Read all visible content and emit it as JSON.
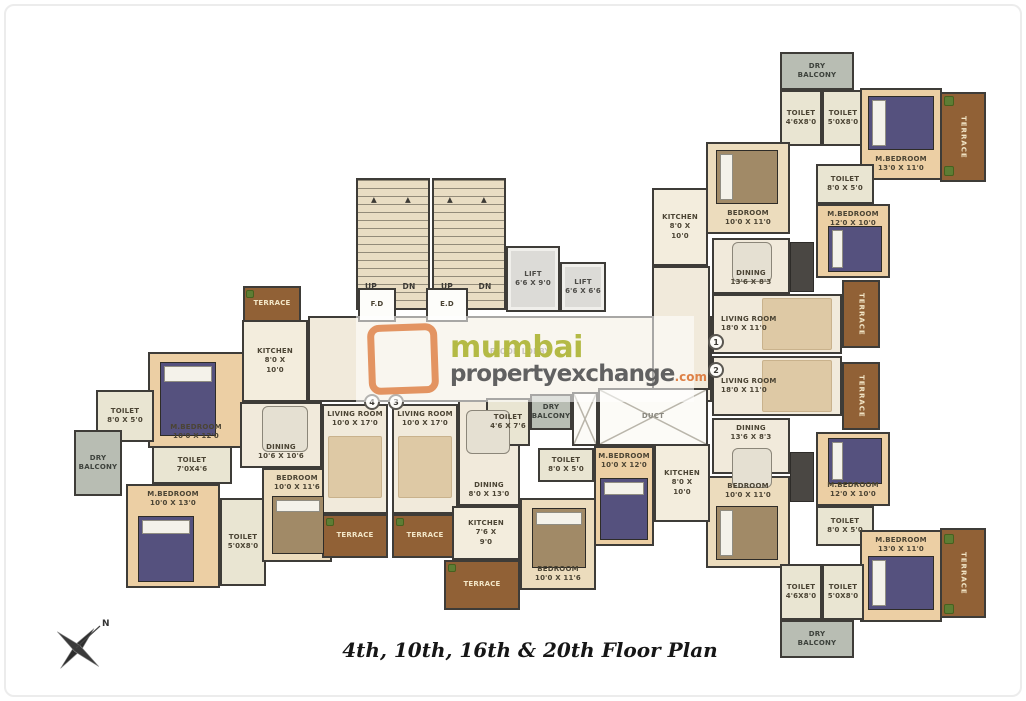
{
  "meta": {
    "title": "4th, 10th, 16th & 20th Floor Plan",
    "compass_label": "N"
  },
  "watermark": {
    "brand_top": "mumbai",
    "brand_bottom": "propertyexchange",
    "brand_suffix": ".com",
    "lobby_label": "FLOOR LOBBY"
  },
  "palette": {
    "wall": "#3e3c38",
    "floor_cream": "#f1eadb",
    "bedroom_tan": "#eccfa4",
    "bedroom_light": "#ecdcbd",
    "toilet": "#e9e5d2",
    "terrace_wood": "#916136",
    "dry_balcony_gray": "#b8bdb3",
    "bed_purple": "#55517e",
    "bed_brown": "#a18a67",
    "plant_green": "#5e7d34",
    "logo_orange": "#e08952",
    "brand_olive": "#b4ba45",
    "brand_gray": "#616161"
  },
  "rooms": [
    {
      "name": "lobby",
      "type": "floor",
      "x": 308,
      "y": 316,
      "w": 404,
      "h": 86
    },
    {
      "name": "corridor-right",
      "type": "floor",
      "x": 652,
      "y": 266,
      "w": 58,
      "h": 124
    },
    {
      "name": "dining-center",
      "type": "floor",
      "x": 458,
      "y": 400,
      "w": 62,
      "h": 106,
      "label": [
        "DINING",
        "8'0 X 13'0"
      ],
      "at": "bottom"
    },
    {
      "name": "stairs-left",
      "type": "stairs",
      "x": 356,
      "y": 178,
      "w": 74,
      "h": 132
    },
    {
      "name": "stairs-right",
      "type": "stairs",
      "x": 432,
      "y": 178,
      "w": 74,
      "h": 132
    },
    {
      "name": "lift-1",
      "type": "lift",
      "x": 506,
      "y": 246,
      "w": 54,
      "h": 66,
      "label": [
        "LIFT",
        "6'6 X 9'0"
      ]
    },
    {
      "name": "lift-2",
      "type": "lift",
      "x": 560,
      "y": 262,
      "w": 46,
      "h": 50,
      "label": [
        "LIFT",
        "6'6 X 6'6"
      ]
    },
    {
      "name": "fd-room",
      "type": "white",
      "x": 358,
      "y": 288,
      "w": 38,
      "h": 34,
      "label": [
        "F.D"
      ]
    },
    {
      "name": "ed-room",
      "type": "white",
      "x": 426,
      "y": 288,
      "w": 42,
      "h": 34,
      "label": [
        "E.D"
      ]
    },
    {
      "name": "terrace-top-left",
      "type": "terrace",
      "x": 243,
      "y": 286,
      "w": 58,
      "h": 36,
      "label": [
        "TERRACE"
      ]
    },
    {
      "name": "kitchen-left",
      "type": "kitchen",
      "x": 242,
      "y": 320,
      "w": 66,
      "h": 82,
      "label": [
        "KITCHEN",
        "8'0 X",
        "10'0"
      ]
    },
    {
      "name": "mbedroom-left-1",
      "type": "tan",
      "x": 148,
      "y": 352,
      "w": 96,
      "h": 96,
      "label": [
        "M.BEDROOM",
        "10'0 X 12'0"
      ],
      "at": "bottom"
    },
    {
      "name": "toilet-left-1",
      "type": "toilet",
      "x": 96,
      "y": 390,
      "w": 58,
      "h": 52,
      "label": [
        "TOILET",
        "8'0 X 5'0"
      ]
    },
    {
      "name": "drybalcony-left",
      "type": "balcony",
      "x": 74,
      "y": 430,
      "w": 48,
      "h": 66,
      "label": [
        "DRY",
        "BALCONY"
      ]
    },
    {
      "name": "toilet-left-2",
      "type": "toilet",
      "x": 152,
      "y": 446,
      "w": 80,
      "h": 38,
      "label": [
        "TOILET",
        "7'0X4'6"
      ]
    },
    {
      "name": "mbedroom-left-2",
      "type": "tan",
      "x": 126,
      "y": 484,
      "w": 94,
      "h": 104,
      "label": [
        "M.BEDROOM",
        "10'0 X 13'0"
      ],
      "at": "top"
    },
    {
      "name": "toilet-left-3",
      "type": "toilet",
      "x": 220,
      "y": 498,
      "w": 46,
      "h": 88,
      "label": [
        "TOILET",
        "5'0X8'0"
      ]
    },
    {
      "name": "bedroom-left",
      "type": "tanlight",
      "x": 262,
      "y": 468,
      "w": 70,
      "h": 94,
      "label": [
        "BEDROOM",
        "10'0 X 11'6"
      ],
      "at": "top"
    },
    {
      "name": "dining-left",
      "type": "floor",
      "x": 240,
      "y": 402,
      "w": 82,
      "h": 66,
      "label": [
        "DINING",
        "10'6 X 10'6"
      ],
      "at": "bottom"
    },
    {
      "name": "living-room-4",
      "type": "floor",
      "x": 322,
      "y": 404,
      "w": 66,
      "h": 110,
      "label": [
        "LIVING ROOM",
        "10'0 X 17'0"
      ],
      "at": "top"
    },
    {
      "name": "terrace-4",
      "type": "terrace",
      "x": 322,
      "y": 514,
      "w": 66,
      "h": 44,
      "label": [
        "TERRACE"
      ]
    },
    {
      "name": "living-room-3",
      "type": "floor",
      "x": 392,
      "y": 404,
      "w": 66,
      "h": 110,
      "label": [
        "LIVING ROOM",
        "10'0 X 17'0"
      ],
      "at": "top"
    },
    {
      "name": "terrace-3",
      "type": "terrace",
      "x": 392,
      "y": 514,
      "w": 66,
      "h": 44,
      "label": [
        "TERRACE"
      ]
    },
    {
      "name": "toilet-center-1",
      "type": "toilet",
      "x": 486,
      "y": 398,
      "w": 44,
      "h": 48,
      "label": [
        "TOILET",
        "4'6 X 7'6"
      ]
    },
    {
      "name": "drybalcony-center",
      "type": "balcony",
      "x": 530,
      "y": 394,
      "w": 42,
      "h": 36,
      "label": [
        "DRY",
        "BALCONY"
      ]
    },
    {
      "name": "duct-shaft",
      "type": "duct",
      "x": 572,
      "y": 392,
      "w": 26,
      "h": 54
    },
    {
      "name": "duct",
      "type": "duct",
      "x": 598,
      "y": 388,
      "w": 110,
      "h": 58,
      "label": [
        "DUCT"
      ]
    },
    {
      "name": "toilet-center-2",
      "type": "toilet",
      "x": 538,
      "y": 448,
      "w": 56,
      "h": 34,
      "label": [
        "TOILET",
        "8'0 X 5'0"
      ]
    },
    {
      "name": "mbedroom-center",
      "type": "tan",
      "x": 594,
      "y": 446,
      "w": 60,
      "h": 100,
      "label": [
        "M.BEDROOM",
        "10'0 X 12'0"
      ],
      "at": "top"
    },
    {
      "name": "kitchen-center",
      "type": "kitchen",
      "x": 452,
      "y": 506,
      "w": 68,
      "h": 54,
      "label": [
        "KITCHEN",
        "7'6 X",
        "9'0"
      ]
    },
    {
      "name": "terrace-center",
      "type": "terrace",
      "x": 444,
      "y": 560,
      "w": 76,
      "h": 50,
      "label": [
        "TERRACE"
      ]
    },
    {
      "name": "bedroom-center",
      "type": "tanlight",
      "x": 520,
      "y": 498,
      "w": 76,
      "h": 92,
      "label": [
        "BEDROOM",
        "10'0 X 11'6"
      ],
      "at": "bottom"
    },
    {
      "name": "drybalcony-right-1",
      "type": "balcony",
      "x": 780,
      "y": 52,
      "w": 74,
      "h": 38,
      "label": [
        "DRY",
        "BALCONY"
      ]
    },
    {
      "name": "toilet-1a",
      "type": "toilet",
      "x": 780,
      "y": 90,
      "w": 42,
      "h": 56,
      "label": [
        "TOILET",
        "4'6X8'0"
      ]
    },
    {
      "name": "toilet-1b",
      "type": "toilet",
      "x": 822,
      "y": 90,
      "w": 42,
      "h": 56,
      "label": [
        "TOILET",
        "5'0X8'0"
      ]
    },
    {
      "name": "mbedroom-1a",
      "type": "tan",
      "x": 860,
      "y": 88,
      "w": 82,
      "h": 92,
      "label": [
        "M.BEDROOM",
        "13'0 X 11'0"
      ],
      "at": "bottom"
    },
    {
      "name": "terrace-1",
      "type": "terrace",
      "x": 940,
      "y": 92,
      "w": 46,
      "h": 90,
      "label": [
        "TERRACE"
      ],
      "vert": true
    },
    {
      "name": "bedroom-1",
      "type": "tanlight",
      "x": 706,
      "y": 142,
      "w": 84,
      "h": 92,
      "label": [
        "BEDROOM",
        "10'0 X 11'0"
      ],
      "at": "bottom"
    },
    {
      "name": "kitchen-1",
      "type": "kitchen",
      "x": 652,
      "y": 188,
      "w": 56,
      "h": 78,
      "label": [
        "KITCHEN",
        "8'0 X",
        "10'0"
      ]
    },
    {
      "name": "toilet-1c",
      "type": "toilet",
      "x": 816,
      "y": 164,
      "w": 58,
      "h": 40,
      "label": [
        "TOILET",
        "8'0 X 5'0"
      ]
    },
    {
      "name": "mbedroom-1b",
      "type": "tan",
      "x": 816,
      "y": 204,
      "w": 74,
      "h": 74,
      "label": [
        "M.BEDROOM",
        "12'0 X 10'0"
      ],
      "at": "top"
    },
    {
      "name": "terrace-1-side",
      "type": "terrace",
      "x": 842,
      "y": 280,
      "w": 38,
      "h": 68,
      "label": [
        "TERRACE"
      ],
      "vert": true
    },
    {
      "name": "dining-1",
      "type": "floor",
      "x": 712,
      "y": 238,
      "w": 78,
      "h": 56,
      "label": [
        "DINING",
        "13'6 X 8'3"
      ],
      "at": "bottom"
    },
    {
      "name": "living-room-1",
      "type": "floor",
      "x": 712,
      "y": 294,
      "w": 130,
      "h": 60,
      "label": [
        "LIVING ROOM",
        "18'0 X 11'0"
      ],
      "at": "left"
    },
    {
      "name": "living-room-2",
      "type": "floor",
      "x": 712,
      "y": 356,
      "w": 130,
      "h": 60,
      "label": [
        "LIVING ROOM",
        "18'0 X 11'0"
      ],
      "at": "left"
    },
    {
      "name": "dining-2",
      "type": "floor",
      "x": 712,
      "y": 418,
      "w": 78,
      "h": 56,
      "label": [
        "DINING",
        "13'6 X 8'3"
      ],
      "at": "top"
    },
    {
      "name": "terrace-2-side",
      "type": "terrace",
      "x": 842,
      "y": 362,
      "w": 38,
      "h": 68,
      "label": [
        "TERRACE"
      ],
      "vert": true
    },
    {
      "name": "mbedroom-2b",
      "type": "tan",
      "x": 816,
      "y": 432,
      "w": 74,
      "h": 74,
      "label": [
        "M.BEDROOM",
        "12'0 X 10'0"
      ],
      "at": "bottom"
    },
    {
      "name": "toilet-2c",
      "type": "toilet",
      "x": 816,
      "y": 506,
      "w": 58,
      "h": 40,
      "label": [
        "TOILET",
        "8'0 X 5'0"
      ]
    },
    {
      "name": "bedroom-2",
      "type": "tanlight",
      "x": 706,
      "y": 476,
      "w": 84,
      "h": 92,
      "label": [
        "BEDROOM",
        "10'0 X 11'0"
      ],
      "at": "top"
    },
    {
      "name": "kitchen-2",
      "type": "kitchen",
      "x": 654,
      "y": 444,
      "w": 56,
      "h": 78,
      "label": [
        "KITCHEN",
        "8'0 X",
        "10'0"
      ]
    },
    {
      "name": "mbedroom-2a",
      "type": "tan",
      "x": 860,
      "y": 530,
      "w": 82,
      "h": 92,
      "label": [
        "M.BEDROOM",
        "13'0 X 11'0"
      ],
      "at": "top"
    },
    {
      "name": "terrace-2",
      "type": "terrace",
      "x": 940,
      "y": 528,
      "w": 46,
      "h": 90,
      "label": [
        "TERRACE"
      ],
      "vert": true
    },
    {
      "name": "toilet-2a",
      "type": "toilet",
      "x": 780,
      "y": 564,
      "w": 42,
      "h": 56,
      "label": [
        "TOILET",
        "4'6X8'0"
      ]
    },
    {
      "name": "toilet-2b",
      "type": "toilet",
      "x": 822,
      "y": 564,
      "w": 42,
      "h": 56,
      "label": [
        "TOILET",
        "5'0X8'0"
      ]
    },
    {
      "name": "drybalcony-right-2",
      "type": "balcony",
      "x": 780,
      "y": 620,
      "w": 74,
      "h": 38,
      "label": [
        "DRY",
        "BALCONY"
      ]
    },
    {
      "name": "up-label-1",
      "type": "plain",
      "noborder": true,
      "x": 358,
      "y": 280,
      "w": 26,
      "h": 14,
      "label": [
        "UP"
      ]
    },
    {
      "name": "dn-label-1",
      "type": "plain",
      "noborder": true,
      "x": 396,
      "y": 280,
      "w": 26,
      "h": 14,
      "label": [
        "DN"
      ]
    },
    {
      "name": "up-label-2",
      "type": "plain",
      "noborder": true,
      "x": 434,
      "y": 280,
      "w": 26,
      "h": 14,
      "label": [
        "UP"
      ]
    },
    {
      "name": "dn-label-2",
      "type": "plain",
      "noborder": true,
      "x": 472,
      "y": 280,
      "w": 26,
      "h": 14,
      "label": [
        "DN"
      ]
    },
    {
      "name": "stair-arrow-1",
      "type": "plain",
      "noborder": true,
      "x": 366,
      "y": 194,
      "w": 16,
      "h": 12,
      "label": [
        "▲"
      ]
    },
    {
      "name": "stair-arrow-2",
      "type": "plain",
      "noborder": true,
      "x": 400,
      "y": 194,
      "w": 16,
      "h": 12,
      "label": [
        "▲"
      ]
    },
    {
      "name": "stair-arrow-3",
      "type": "plain",
      "noborder": true,
      "x": 442,
      "y": 194,
      "w": 16,
      "h": 12,
      "label": [
        "▲"
      ]
    },
    {
      "name": "stair-arrow-4",
      "type": "plain",
      "noborder": true,
      "x": 476,
      "y": 194,
      "w": 16,
      "h": 12,
      "label": [
        "▲"
      ]
    }
  ],
  "furniture": [
    {
      "kind": "bed-purple",
      "p": "top",
      "x": 160,
      "y": 362,
      "w": 56,
      "h": 74
    },
    {
      "kind": "bed-purple",
      "p": "top",
      "x": 138,
      "y": 516,
      "w": 56,
      "h": 66
    },
    {
      "kind": "bed-purple",
      "p": "top",
      "x": 600,
      "y": 478,
      "w": 48,
      "h": 62
    },
    {
      "kind": "bed-purple",
      "p": "left",
      "x": 868,
      "y": 96,
      "w": 66,
      "h": 54
    },
    {
      "kind": "bed-purple",
      "p": "left",
      "x": 828,
      "y": 226,
      "w": 54,
      "h": 46
    },
    {
      "kind": "bed-purple",
      "p": "left",
      "x": 828,
      "y": 438,
      "w": 54,
      "h": 46
    },
    {
      "kind": "bed-purple",
      "p": "left",
      "x": 868,
      "y": 556,
      "w": 66,
      "h": 54
    },
    {
      "kind": "bed-brown",
      "p": "top",
      "x": 272,
      "y": 496,
      "w": 52,
      "h": 58
    },
    {
      "kind": "bed-brown",
      "p": "top",
      "x": 532,
      "y": 508,
      "w": 54,
      "h": 60
    },
    {
      "kind": "bed-brown",
      "p": "left",
      "x": 716,
      "y": 150,
      "w": 62,
      "h": 54
    },
    {
      "kind": "bed-brown",
      "p": "left",
      "x": 716,
      "y": 506,
      "w": 62,
      "h": 54
    },
    {
      "kind": "table",
      "x": 262,
      "y": 406,
      "w": 46,
      "h": 46
    },
    {
      "kind": "table",
      "x": 466,
      "y": 410,
      "w": 44,
      "h": 44
    },
    {
      "kind": "table",
      "x": 732,
      "y": 242,
      "w": 40,
      "h": 40
    },
    {
      "kind": "table",
      "x": 732,
      "y": 448,
      "w": 40,
      "h": 40
    },
    {
      "kind": "rug",
      "x": 328,
      "y": 436,
      "w": 54,
      "h": 62
    },
    {
      "kind": "rug",
      "x": 398,
      "y": 436,
      "w": 54,
      "h": 62
    },
    {
      "kind": "rug",
      "x": 762,
      "y": 298,
      "w": 70,
      "h": 52
    },
    {
      "kind": "rug",
      "x": 762,
      "y": 360,
      "w": 70,
      "h": 52
    },
    {
      "kind": "wardrobe",
      "x": 790,
      "y": 242,
      "w": 24,
      "h": 50
    },
    {
      "kind": "wardrobe",
      "x": 790,
      "y": 452,
      "w": 24,
      "h": 50
    },
    {
      "kind": "plant",
      "x": 944,
      "y": 96,
      "w": 10,
      "h": 10
    },
    {
      "kind": "plant",
      "x": 944,
      "y": 166,
      "w": 10,
      "h": 10
    },
    {
      "kind": "plant",
      "x": 944,
      "y": 534,
      "w": 10,
      "h": 10
    },
    {
      "kind": "plant",
      "x": 944,
      "y": 604,
      "w": 10,
      "h": 10
    },
    {
      "kind": "plant",
      "x": 246,
      "y": 290,
      "w": 8,
      "h": 8
    },
    {
      "kind": "plant",
      "x": 448,
      "y": 564,
      "w": 8,
      "h": 8
    },
    {
      "kind": "plant",
      "x": 326,
      "y": 518,
      "w": 8,
      "h": 8
    },
    {
      "kind": "plant",
      "x": 396,
      "y": 518,
      "w": 8,
      "h": 8
    }
  ],
  "unit_markers": [
    {
      "n": "4",
      "x": 364,
      "y": 394
    },
    {
      "n": "3",
      "x": 388,
      "y": 394
    },
    {
      "n": "1",
      "x": 708,
      "y": 334
    },
    {
      "n": "2",
      "x": 708,
      "y": 362
    }
  ]
}
